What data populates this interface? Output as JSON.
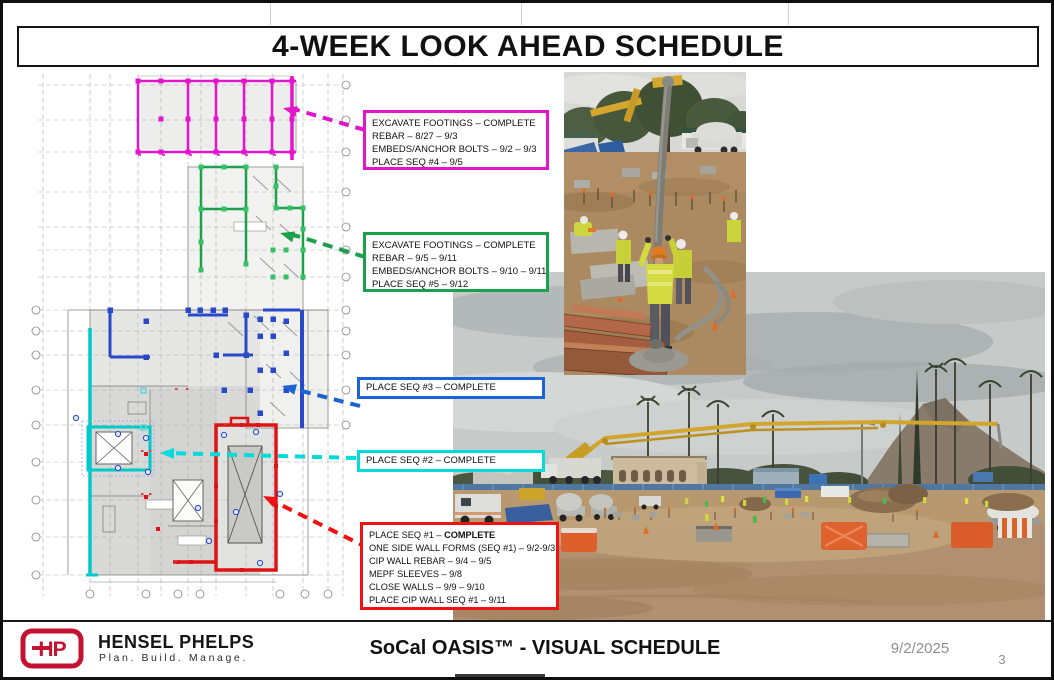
{
  "title": "4-WEEK LOOK AHEAD SCHEDULE",
  "callouts": [
    {
      "name": "sequence-4",
      "color": "#e215cb",
      "lines": [
        "EXCAVATE FOOTINGS – COMPLETE",
        "REBAR – 8/27 – 9/3",
        "EMBEDS/ANCHOR BOLTS – 9/2 – 9/3",
        "PLACE SEQ #4 – 9/5"
      ]
    },
    {
      "name": "sequence-5",
      "color": "#1ca04b",
      "lines": [
        "EXCAVATE FOOTINGS – COMPLETE",
        "REBAR – 9/5 – 9/11",
        "EMBEDS/ANCHOR BOLTS – 9/10 – 9/11",
        "PLACE SEQ #5 – 9/12"
      ]
    },
    {
      "name": "sequence-3",
      "color": "#1b64d2",
      "lines": [
        "PLACE SEQ #3 – COMPLETE"
      ]
    },
    {
      "name": "sequence-2",
      "color": "#00dbdb",
      "lines": [
        "PLACE SEQ #2 – COMPLETE"
      ]
    },
    {
      "name": "sequence-1",
      "color": "#ee1212",
      "lines": [
        {
          "prefix": "PLACE SEQ #1 – ",
          "bold": "COMPLETE"
        },
        "ONE SIDE WALL FORMS (SEQ #1) – 9/2-9/3",
        "CIP WALL REBAR – 9/4 – 9/5",
        "MEPF SLEEVES – 9/8",
        "CLOSE WALLS – 9/9 – 9/10",
        "PLACE CIP WALL SEQ #1 – 9/11"
      ]
    }
  ],
  "footer": {
    "logo_monogram": "HP",
    "company": "HENSEL PHELPS",
    "tagline": "Plan. Build. Manage.",
    "center_title": "SoCal OASIS™ - VISUAL SCHEDULE",
    "date": "9/2/2025",
    "page_number": "3"
  },
  "colors": {
    "seq4_magenta": "#e215cb",
    "seq5_green": "#1ca04b",
    "seq3_blue": "#1b64d2",
    "seq2_cyan": "#00dbdb",
    "seq1_red": "#ee1212",
    "logo_red": "#c41230",
    "footer_gray": "#8f8f8f"
  }
}
